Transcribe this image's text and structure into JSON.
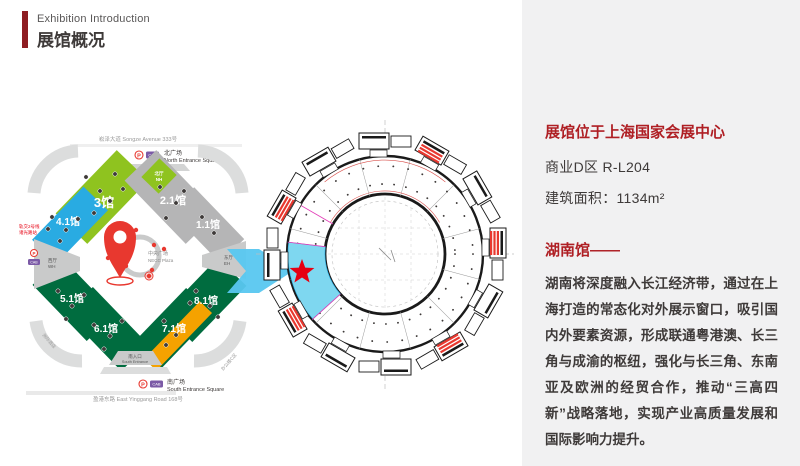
{
  "header": {
    "kicker": "Exhibition Introduction",
    "title": "展馆概况"
  },
  "map": {
    "road_top": "崧泽大道 Songze Avenue 333号",
    "road_bottom": "盈港东路 East Yinggang Road 168号",
    "north_square_zh": "北广场",
    "north_square_en": "North Entrance Square",
    "south_square_zh": "南广场",
    "south_square_en": "South Entrance Square",
    "south_entrance_zh": "南入口",
    "south_entrance_en": "South Entrance",
    "plaza_zh": "中央广场",
    "plaza_en": "NECC Plaza",
    "halls": {
      "h3": "3馆",
      "h21": "2.1馆",
      "h11": "1.1馆",
      "h41": "4.1馆",
      "h51": "5.1馆",
      "h61": "6.1馆",
      "h71": "7.1馆",
      "h81": "8.1馆"
    },
    "north_hall_zh": "北厅",
    "north_hall_en": "NH",
    "west_hall_zh": "西厅",
    "west_hall_en": "WH",
    "east_hall_zh": "东厅",
    "east_hall_en": "EH",
    "metro_line1": "轨交2号线",
    "metro_line2": "诸光路站",
    "hotel_label": "洲际酒店",
    "office_label": "办公楼C区",
    "p_icon": "P",
    "cab_icon": "CAB"
  },
  "floorplan": {
    "highlight": "#7ED7F0",
    "star": "#E60012"
  },
  "panel": {
    "location": "展馆位于上海国家会展中心",
    "zone": "商业D区  R-L204",
    "area": "建筑面积：1134m²",
    "pavilion": "湖南馆——",
    "description": "湖南将深度融入长江经济带，通过在上海打造的常态化对外展示窗口，吸引国内外要素资源，形成联通粤港澳、长三角与成渝的枢纽，强化与长三角、东南亚及欧洲的经贸合作，推动“三高四新”战略落地，实现产业高质量发展和国际影响力提升。"
  },
  "colors": {
    "accent_red": "#AF1F24",
    "pin_red": "#E8382F",
    "hall_light_green": "#8FC31F",
    "hall_dark_green": "#006C3F",
    "hall_blue": "#29ABE2",
    "hall_gray": "#B5B5B6",
    "hall_orange": "#F5A200",
    "arrow_cyan": "#58C7F0",
    "panel_bg": "#F1F1F2"
  }
}
